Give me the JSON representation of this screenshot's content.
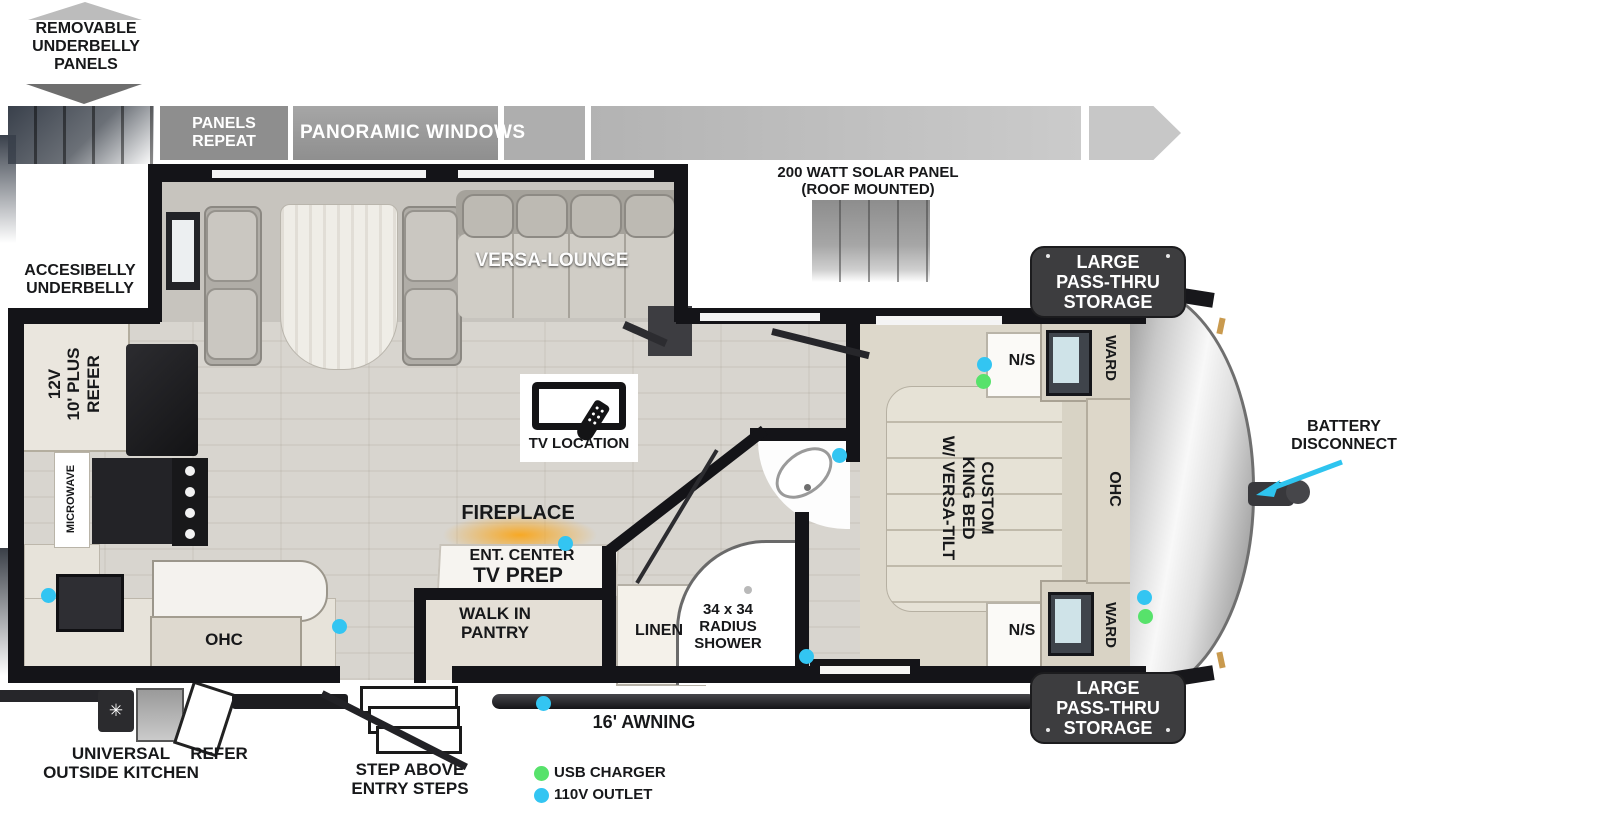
{
  "annotations": {
    "removable_underbelly": "REMOVABLE\nUNDERBELLY\nPANELS",
    "panels_repeat": "PANELS\nREPEAT",
    "panoramic_windows": "PANORAMIC WINDOWS",
    "solar_panel": "200 WATT SOLAR PANEL\n(ROOF MOUNTED)",
    "accesibelly_underbelly": "ACCESIBELLY\nUNDERBELLY",
    "battery_disconnect": "BATTERY\nDISCONNECT",
    "pass_thru_storage": "LARGE\nPASS-THRU\nSTORAGE",
    "awning": "16' AWNING",
    "step_above": "STEP ABOVE\nENTRY STEPS",
    "universal_outside_kitchen": "UNIVERSAL\nOUTSIDE KITCHEN",
    "outside_refer": "REFER"
  },
  "rooms": {
    "versa_lounge": "VERSA-LOUNGE",
    "tv_location": "TV LOCATION",
    "fireplace": "FIREPLACE",
    "ent_center": "ENT. CENTER",
    "tv_prep": "TV PREP",
    "walk_in_pantry": "WALK IN\nPANTRY",
    "linen": "LINEN",
    "shower": "34 x 34\nRADIUS\nSHOWER",
    "king_bed": "CUSTOM\nKING BED\nW/ VERSA-TILT",
    "nightstand": "N/S",
    "wardrobe": "WARD",
    "overhead_cabinet": "OHC",
    "refrigerator": "12V\n10' PLUS\nREFER",
    "microwave": "MICROWAVE"
  },
  "legend": {
    "items": [
      {
        "label": "USB CHARGER",
        "color": "#57e26b"
      },
      {
        "label": "110V OUTLET",
        "color": "#33c5f2"
      }
    ]
  }
}
